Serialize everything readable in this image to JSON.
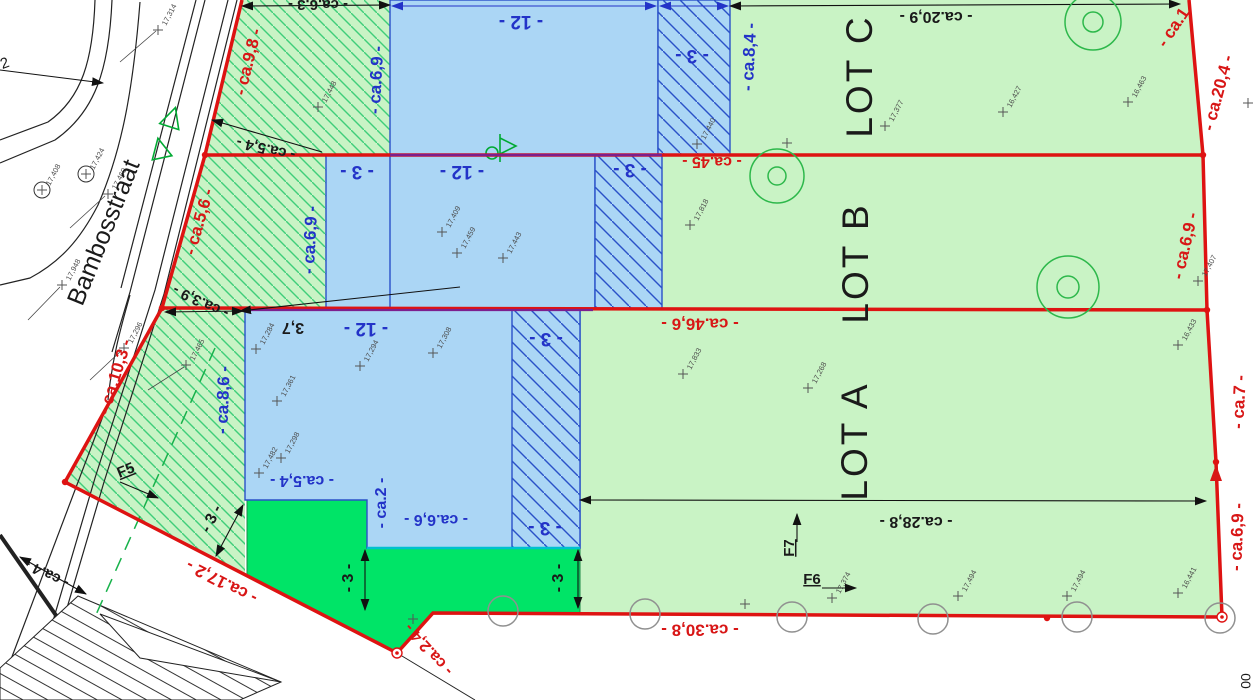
{
  "plan": {
    "street_name": "Bambosstraat",
    "lots": [
      {
        "name": "LOT A"
      },
      {
        "name": "LOT B"
      },
      {
        "name": "LOT C"
      }
    ],
    "colors": {
      "boundary_red": "#d81616",
      "dimension_blue": "#2333c8",
      "building_fill": "#abd6f5",
      "front_strip_fill": "#c9f3c5",
      "front_strip_hatch": "#3fce7a",
      "lot_fill": "#c9f3c5",
      "accent_green": "#00e467",
      "purple_overlap": "#7d1f8d",
      "cyan_edge": "#00c0cf",
      "tree_green": "#2db84b"
    },
    "labels": [
      {
        "t": "- ca.9,8 -",
        "x": 249,
        "y": 62,
        "r": -76,
        "c": "red",
        "s": 17,
        "w": 700
      },
      {
        "t": "- ca.5,6 -",
        "x": 200,
        "y": 222,
        "r": -74,
        "c": "red",
        "s": 17,
        "w": 700
      },
      {
        "t": "- ca.10,3 -",
        "x": 116,
        "y": 377,
        "r": -73,
        "c": "red",
        "s": 17,
        "w": 700
      },
      {
        "t": "- ca.17,2 -",
        "x": 222,
        "y": 581,
        "r": 207,
        "c": "red",
        "s": 17,
        "w": 700
      },
      {
        "t": "- ca.2,4 -",
        "x": 429,
        "y": 649,
        "r": 228,
        "c": "red",
        "s": 16,
        "w": 700
      },
      {
        "t": "- ca.30,8 -",
        "x": 700,
        "y": 629,
        "r": 180,
        "c": "red",
        "s": 17,
        "w": 700
      },
      {
        "t": "- ca.6,9 -",
        "x": 1238,
        "y": 537,
        "r": -88,
        "c": "red",
        "s": 17,
        "w": 700
      },
      {
        "t": "- ca.7 -",
        "x": 1240,
        "y": 402,
        "r": -87,
        "c": "red",
        "s": 17,
        "w": 700
      },
      {
        "t": "- ca.6,9 -",
        "x": 1186,
        "y": 246,
        "r": -77,
        "c": "red",
        "s": 17,
        "w": 700
      },
      {
        "t": "- ca.20,4 -",
        "x": 1219,
        "y": 93,
        "r": -75,
        "c": "red",
        "s": 17,
        "w": 700
      },
      {
        "t": "- ca.1",
        "x": 1174,
        "y": 28,
        "r": -56,
        "c": "red",
        "s": 17,
        "w": 700
      },
      {
        "t": "- ca.45 -",
        "x": 712,
        "y": 161,
        "r": 180,
        "c": "red",
        "s": 16,
        "w": 700
      },
      {
        "t": "- ca.46,6 -",
        "x": 700,
        "y": 323,
        "r": 180,
        "c": "red",
        "s": 17,
        "w": 700
      },
      {
        "t": "- ca.20,9 -",
        "x": 936,
        "y": 16,
        "r": 180,
        "c": "black",
        "s": 16,
        "w": 700
      },
      {
        "t": "- ca.28,8 -",
        "x": 916,
        "y": 521,
        "r": 180,
        "c": "black",
        "s": 16,
        "w": 700
      },
      {
        "t": "- ca.5,4 -",
        "x": 266,
        "y": 148,
        "r": 193,
        "c": "black",
        "s": 15,
        "w": 700
      },
      {
        "t": "- ca.3,9 -",
        "x": 201,
        "y": 301,
        "r": 205,
        "c": "black",
        "s": 15,
        "w": 700
      },
      {
        "t": "- ca.4 -",
        "x": 47,
        "y": 573,
        "r": 206,
        "c": "black",
        "s": 15,
        "w": 700
      },
      {
        "t": "3,7",
        "x": 293,
        "y": 327,
        "r": 180,
        "c": "black",
        "s": 16,
        "w": 700
      },
      {
        "t": "- ca.6,3 -",
        "x": 318,
        "y": 4,
        "r": 180,
        "c": "black",
        "s": 15,
        "w": 700
      },
      {
        "t": "- ca.6,9 -",
        "x": 377,
        "y": 80,
        "r": -87,
        "c": "blue",
        "s": 17,
        "w": 700
      },
      {
        "t": "- ca.8,4 -",
        "x": 750,
        "y": 57,
        "r": -87,
        "c": "blue",
        "s": 17,
        "w": 700
      },
      {
        "t": "- ca.6,9 -",
        "x": 311,
        "y": 240,
        "r": -87,
        "c": "blue",
        "s": 17,
        "w": 700
      },
      {
        "t": "- ca.8,6 -",
        "x": 224,
        "y": 400,
        "r": -88,
        "c": "blue",
        "s": 17,
        "w": 700
      },
      {
        "t": "- ca.5,4 -",
        "x": 302,
        "y": 480,
        "r": 180,
        "c": "blue",
        "s": 16,
        "w": 700
      },
      {
        "t": "- ca.2 -",
        "x": 382,
        "y": 503,
        "r": -90,
        "c": "blue",
        "s": 16,
        "w": 700
      },
      {
        "t": "- ca.6,6 -",
        "x": 436,
        "y": 519,
        "r": 180,
        "c": "blue",
        "s": 16,
        "w": 700
      },
      {
        "t": "- 12 -",
        "x": 521,
        "y": 21,
        "r": 180,
        "c": "blue",
        "s": 19,
        "w": 700
      },
      {
        "t": "- 3 -",
        "x": 692,
        "y": 55,
        "r": 180,
        "c": "blue",
        "s": 19,
        "w": 700
      },
      {
        "t": "- 3 -",
        "x": 357,
        "y": 171,
        "r": 180,
        "c": "blue",
        "s": 19,
        "w": 700
      },
      {
        "t": "- 12 -",
        "x": 462,
        "y": 171,
        "r": 180,
        "c": "blue",
        "s": 19,
        "w": 700
      },
      {
        "t": "- 3 -",
        "x": 630,
        "y": 169,
        "r": 180,
        "c": "blue",
        "s": 19,
        "w": 700
      },
      {
        "t": "- 12 -",
        "x": 366,
        "y": 328,
        "r": 180,
        "c": "blue",
        "s": 19,
        "w": 700
      },
      {
        "t": "- 3 -",
        "x": 546,
        "y": 338,
        "r": 180,
        "c": "blue",
        "s": 19,
        "w": 700
      },
      {
        "t": "- 3 -",
        "x": 545,
        "y": 527,
        "r": 180,
        "c": "blue",
        "s": 19,
        "w": 700
      },
      {
        "t": "- 3 -",
        "x": 212,
        "y": 519,
        "r": -63,
        "c": "black",
        "s": 16,
        "w": 700
      },
      {
        "t": "- 3 -",
        "x": 349,
        "y": 578,
        "r": -90,
        "c": "black",
        "s": 16,
        "w": 700
      },
      {
        "t": "- 3 -",
        "x": 559,
        "y": 578,
        "r": -90,
        "c": "black",
        "s": 16,
        "w": 700
      },
      {
        "t": "LOT C",
        "x": 862,
        "y": 76,
        "r": -90,
        "c": "black",
        "s": 37,
        "w": 400,
        "ls": 3,
        "n": "lot-label-c"
      },
      {
        "t": "LOT B",
        "x": 858,
        "y": 263,
        "r": -90,
        "c": "black",
        "s": 37,
        "w": 400,
        "ls": 3,
        "n": "lot-label-b"
      },
      {
        "t": "LOT A",
        "x": 857,
        "y": 441,
        "r": -90,
        "c": "black",
        "s": 37,
        "w": 400,
        "ls": 3,
        "n": "lot-label-a"
      },
      {
        "t": "Bambosstraat",
        "x": 105,
        "y": 233,
        "r": -68,
        "c": "black",
        "s": 25,
        "w": 400,
        "n": "street-name"
      },
      {
        "t": "F5",
        "x": 126,
        "y": 471,
        "r": -22,
        "c": "black",
        "s": 15,
        "w": 700,
        "u": 1,
        "n": "ref-label-f5"
      },
      {
        "t": "F6",
        "x": 812,
        "y": 580,
        "r": 0,
        "c": "black",
        "s": 15,
        "w": 700,
        "u": 1,
        "n": "ref-label-f6"
      },
      {
        "t": "F7",
        "x": 790,
        "y": 548,
        "r": -90,
        "c": "black",
        "s": 15,
        "w": 700,
        "u": 1,
        "n": "ref-label-f7"
      },
      {
        "t": "2",
        "x": 5,
        "y": 64,
        "r": -20,
        "c": "black",
        "s": 15,
        "w": 400,
        "n": "ref-label-2"
      },
      {
        "t": "00",
        "x": 1247,
        "y": 681,
        "r": -90,
        "c": "black",
        "s": 14,
        "w": 400,
        "n": "ref-label-00"
      }
    ],
    "elevation_markers": [
      {
        "x": 158,
        "y": 30,
        "v": "17,314"
      },
      {
        "x": 86,
        "y": 174,
        "v": "17,424",
        "circ": 1
      },
      {
        "x": 42,
        "y": 190,
        "v": "17,408",
        "circ": 1
      },
      {
        "x": 108,
        "y": 194,
        "v": "17,460"
      },
      {
        "x": 62,
        "y": 285,
        "v": "17,948"
      },
      {
        "x": 124,
        "y": 348,
        "v": "17,296"
      },
      {
        "x": 186,
        "y": 365,
        "v": "17,465"
      },
      {
        "x": 318,
        "y": 107,
        "v": "17,448"
      },
      {
        "x": 697,
        "y": 144,
        "v": "17,440"
      },
      {
        "x": 442,
        "y": 232,
        "v": "17,409"
      },
      {
        "x": 457,
        "y": 253,
        "v": "17,459"
      },
      {
        "x": 503,
        "y": 258,
        "v": "17,443"
      },
      {
        "x": 690,
        "y": 225,
        "v": "17,818"
      },
      {
        "x": 885,
        "y": 126,
        "v": "17,377"
      },
      {
        "x": 1003,
        "y": 112,
        "v": "16,427"
      },
      {
        "x": 1128,
        "y": 102,
        "v": "16,463"
      },
      {
        "x": 1248,
        "y": 103,
        "v": ""
      },
      {
        "x": 787,
        "y": 143,
        "v": ""
      },
      {
        "x": 256,
        "y": 349,
        "v": "17,284"
      },
      {
        "x": 360,
        "y": 366,
        "v": "17,294"
      },
      {
        "x": 433,
        "y": 353,
        "v": "17,308"
      },
      {
        "x": 277,
        "y": 401,
        "v": "17,361"
      },
      {
        "x": 281,
        "y": 458,
        "v": "17,298"
      },
      {
        "x": 259,
        "y": 473,
        "v": "17,482"
      },
      {
        "x": 683,
        "y": 374,
        "v": "17,833"
      },
      {
        "x": 808,
        "y": 388,
        "v": "17,268"
      },
      {
        "x": 832,
        "y": 598,
        "v": "17,374"
      },
      {
        "x": 958,
        "y": 596,
        "v": "17,494"
      },
      {
        "x": 1067,
        "y": 596,
        "v": "17,494"
      },
      {
        "x": 1178,
        "y": 593,
        "v": "16,441"
      },
      {
        "x": 1178,
        "y": 345,
        "v": "16,433"
      },
      {
        "x": 1198,
        "y": 281,
        "v": "17,407"
      },
      {
        "x": 413,
        "y": 619,
        "v": ""
      },
      {
        "x": 745,
        "y": 604,
        "v": ""
      }
    ],
    "trees": [
      {
        "x": 1093,
        "y": 22,
        "r": 28
      },
      {
        "x": 777,
        "y": 176,
        "r": 27
      },
      {
        "x": 1068,
        "y": 287,
        "r": 31
      }
    ],
    "survey_circles": [
      {
        "x": 503,
        "y": 611
      },
      {
        "x": 645,
        "y": 614
      },
      {
        "x": 792,
        "y": 617
      },
      {
        "x": 933,
        "y": 619
      },
      {
        "x": 1077,
        "y": 617
      },
      {
        "x": 1220,
        "y": 618
      }
    ],
    "red_dots": [
      {
        "x": 205,
        "y": 155
      },
      {
        "x": 162,
        "y": 308
      },
      {
        "x": 65,
        "y": 482
      },
      {
        "x": 1203,
        "y": 155
      },
      {
        "x": 1207,
        "y": 310
      },
      {
        "x": 1216,
        "y": 462
      },
      {
        "x": 1047,
        "y": 618
      }
    ],
    "red_rings": [
      {
        "x": 397,
        "y": 653
      },
      {
        "x": 1222,
        "y": 617
      }
    ]
  }
}
